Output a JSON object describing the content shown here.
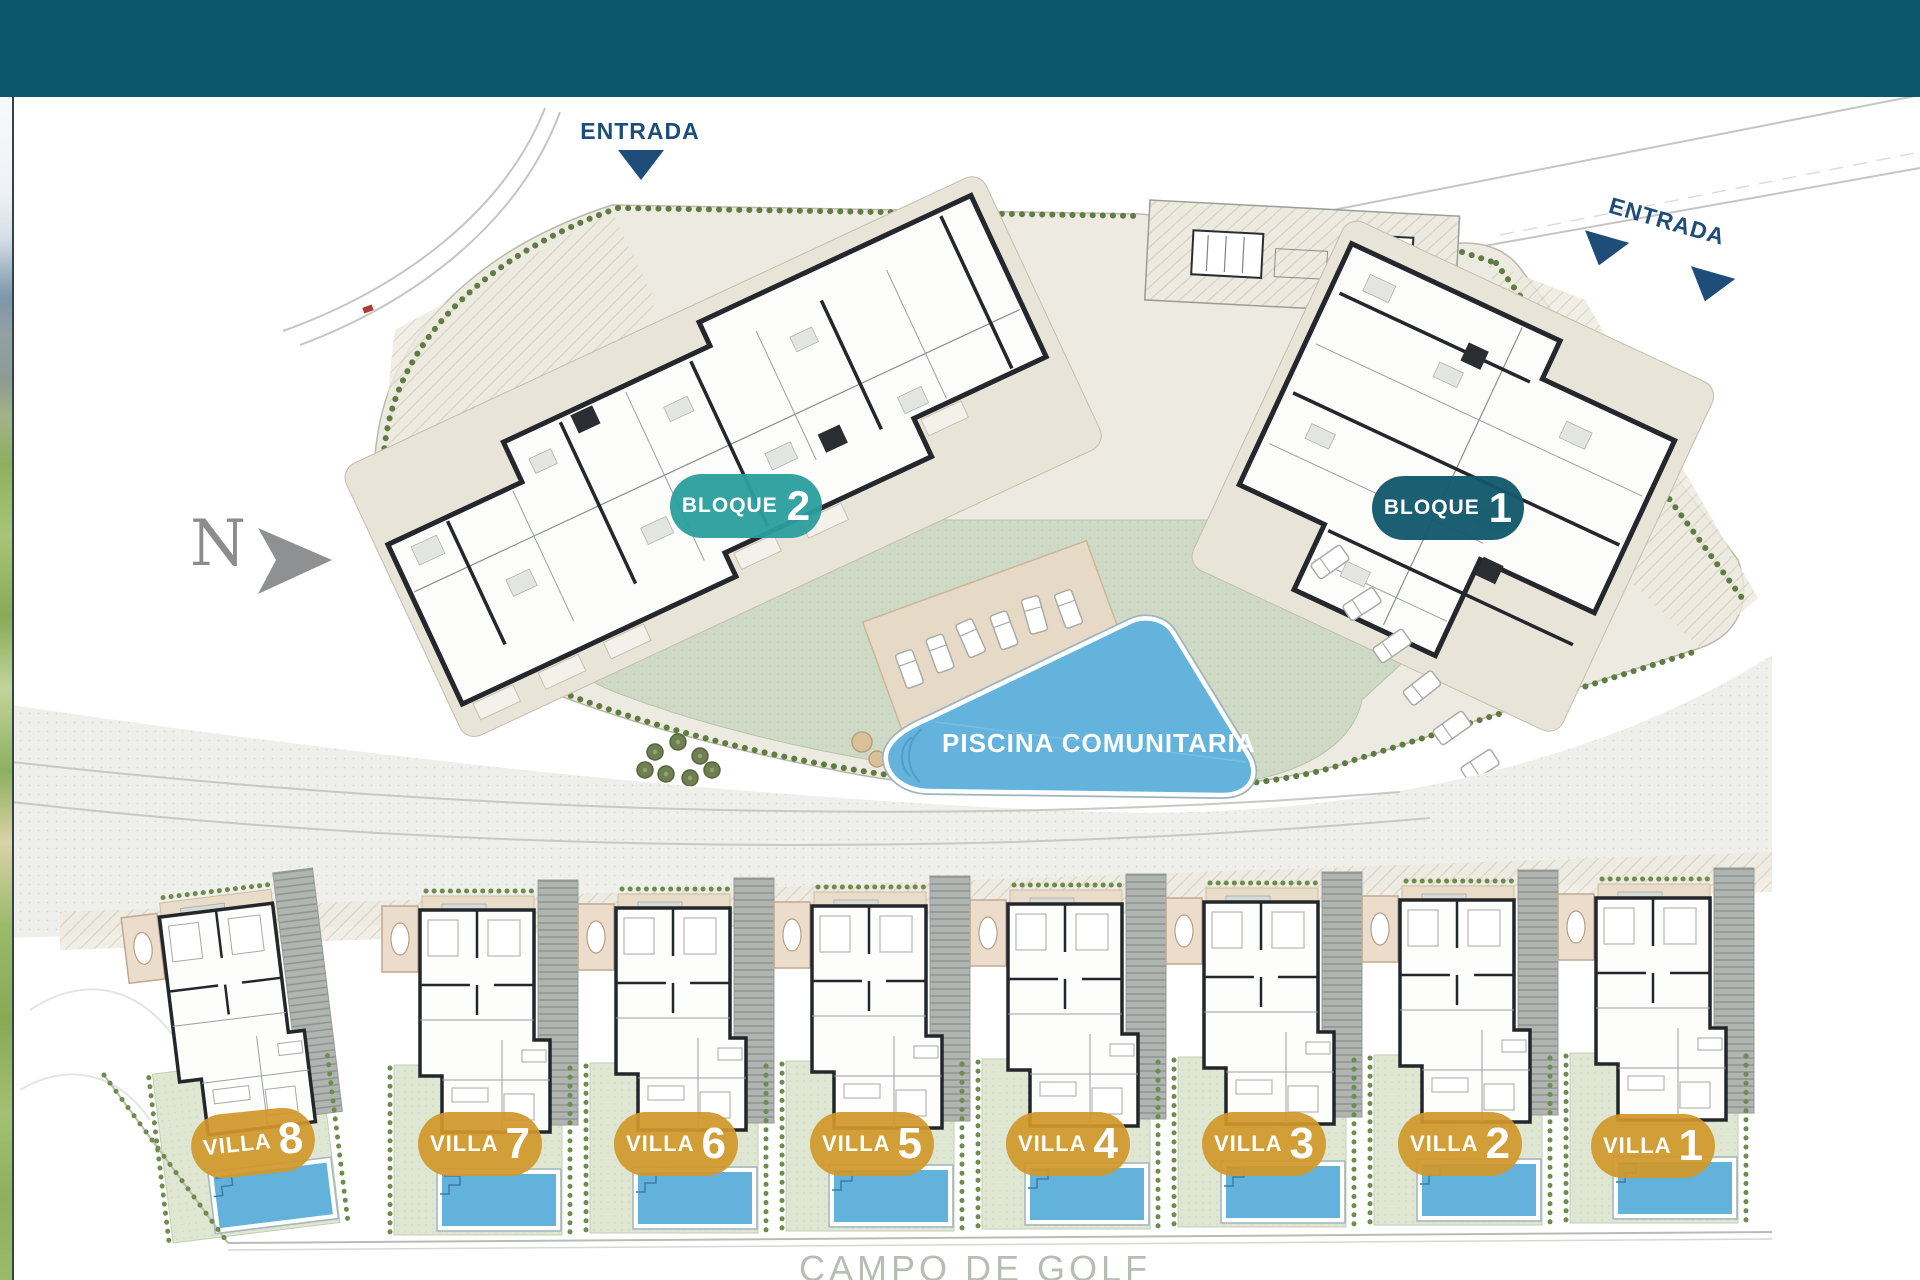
{
  "header_bar": {
    "color": "#0c5769"
  },
  "side_photo": {
    "description": "golf-course-photo-strip"
  },
  "plan": {
    "entrance_labels": [
      "ENTRADA",
      "ENTRADA"
    ],
    "entrance_color": "#1d4d78",
    "north_indicator": "N",
    "blocks": [
      {
        "label": "BLOQUE",
        "number": "2",
        "badge_color": "#2b9e9e"
      },
      {
        "label": "BLOQUE",
        "number": "1",
        "badge_color": "#13586d"
      }
    ],
    "pool_label": "PISCINA COMUNITARIA",
    "pool_color": "#64b3dd",
    "villa_badge_color": "#d1982b",
    "villas": [
      {
        "label": "VILLA",
        "number": "8"
      },
      {
        "label": "VILLA",
        "number": "7"
      },
      {
        "label": "VILLA",
        "number": "6"
      },
      {
        "label": "VILLA",
        "number": "5"
      },
      {
        "label": "VILLA",
        "number": "4"
      },
      {
        "label": "VILLA",
        "number": "3"
      },
      {
        "label": "VILLA",
        "number": "2"
      },
      {
        "label": "VILLA",
        "number": "1"
      }
    ],
    "golf_course_label": "CAMPO DE GOLF"
  }
}
